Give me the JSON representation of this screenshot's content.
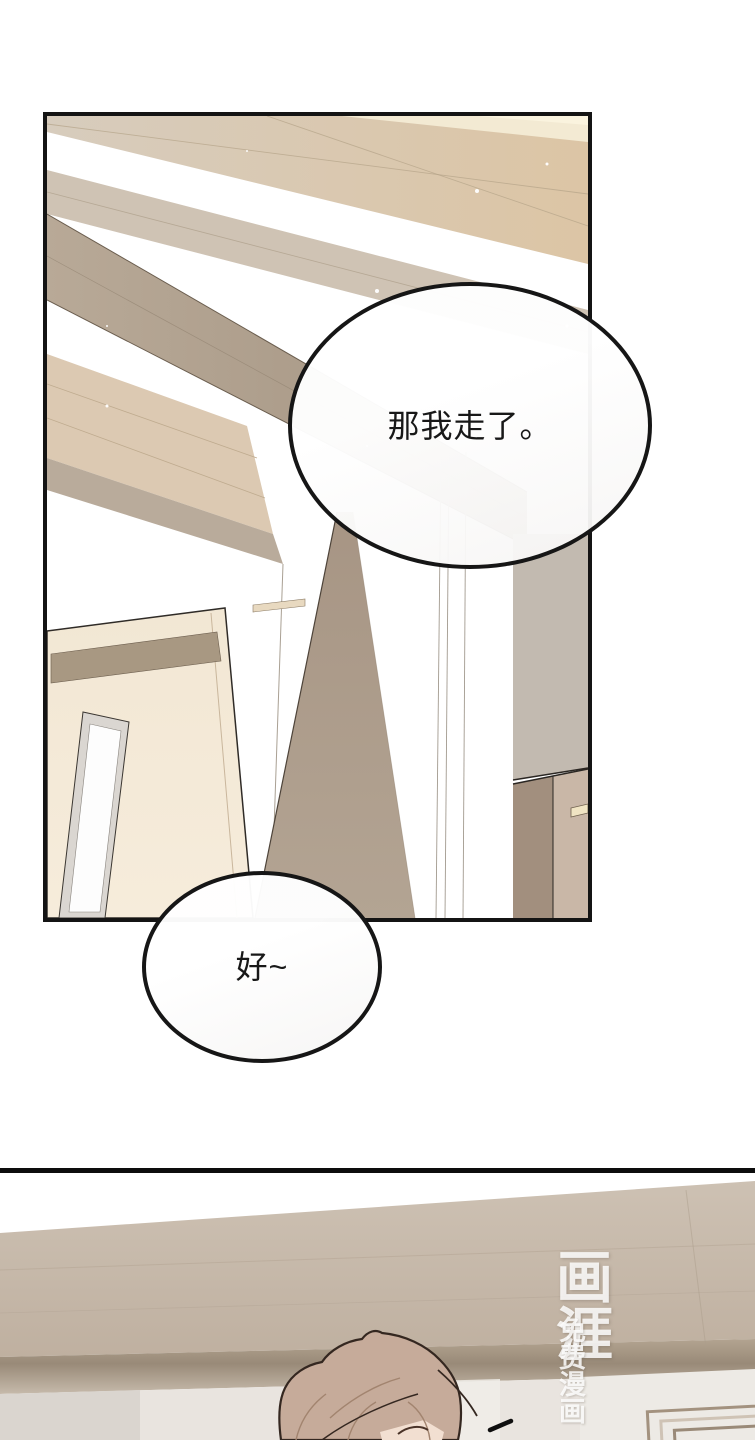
{
  "page": {
    "width": 755,
    "height": 1440,
    "background": "#ffffff"
  },
  "panel1": {
    "description": "interior scene: ceiling beams, open door with narrow window, pillars, cabinet",
    "border_color": "#141414",
    "palette": {
      "ceiling_cream": "#f5eed6",
      "ceiling_tan": "#dcc5a5",
      "ceiling_beige": "#d7ccbd",
      "beam_taupe": "#ab9b89",
      "plank_beige": "#dcc9b2",
      "door_cream": "#f2e7d4",
      "door_lintel": "#a89882",
      "window_frame": "#dad6d1",
      "pillar_taupe": "#a79584",
      "column_gray": "#c2bab0",
      "cabinet_dark": "#a28f7e",
      "cabinet_light": "#c9b7a7",
      "wall_white": "#ffffff"
    }
  },
  "bubbles": [
    {
      "text": "那我走了。"
    },
    {
      "text": "好~"
    }
  ],
  "panel2": {
    "description": "hallway crown molding with character head entering from bottom",
    "border_color": "#0d0d0d",
    "watermark": {
      "logo": "画涯",
      "tagline": "免费漫画",
      "color": "rgba(255,255,255,0.84)"
    },
    "palette": {
      "molding_light": "#cdc1b3",
      "molding_dark": "#bfb0a0",
      "fascia_shadow": "#998a78",
      "wall_light": "#e9e4df",
      "hair": "#c6ab9a",
      "hair_outline": "#342720",
      "skin": "#f2dfd1"
    }
  }
}
